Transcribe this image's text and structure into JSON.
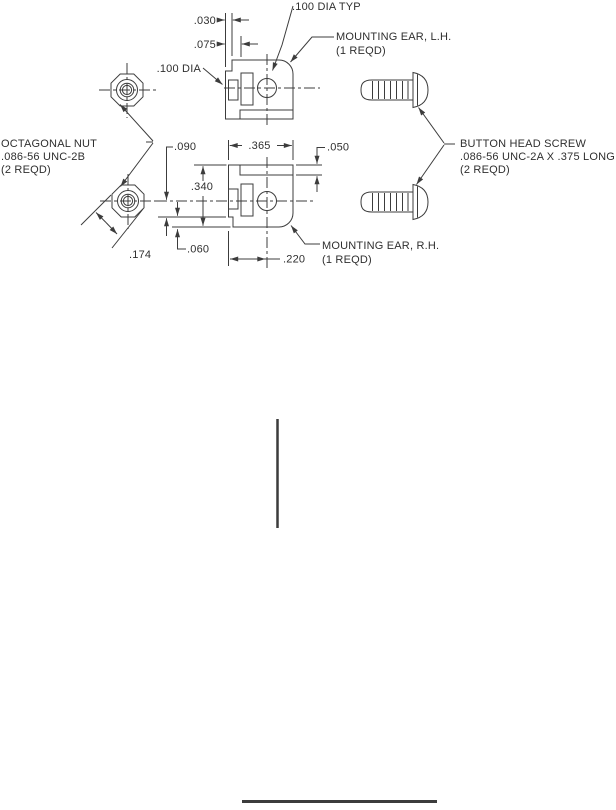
{
  "drawing": {
    "colors": {
      "line": "#3c3c3c",
      "text": "#2f2f2f",
      "background": "#ffffff"
    },
    "dims": {
      "d030": ".030",
      "d075": ".075",
      "d100dia": ".100 DIA",
      "d100diatyp": ".100 DIA TYP",
      "d090": ".090",
      "d340": ".340",
      "d365": ".365",
      "d050": ".050",
      "d060": ".060",
      "d220": ".220",
      "d174": ".174"
    },
    "callouts": {
      "ear_lh": {
        "l1": "MOUNTING EAR, L.H.",
        "l2": "(1 REQD)"
      },
      "ear_rh": {
        "l1": "MOUNTING EAR, R.H.",
        "l2": "(1 REQD)"
      },
      "nut": {
        "l1": "OCTAGONAL NUT",
        "l2": ".086-56 UNC-2B",
        "l3": "(2 REQD)"
      },
      "screw": {
        "l1": "BUTTON HEAD SCREW",
        "l2": ".086-56 UNC-2A X .375 LONG",
        "l3": "(2 REQD)"
      }
    }
  }
}
